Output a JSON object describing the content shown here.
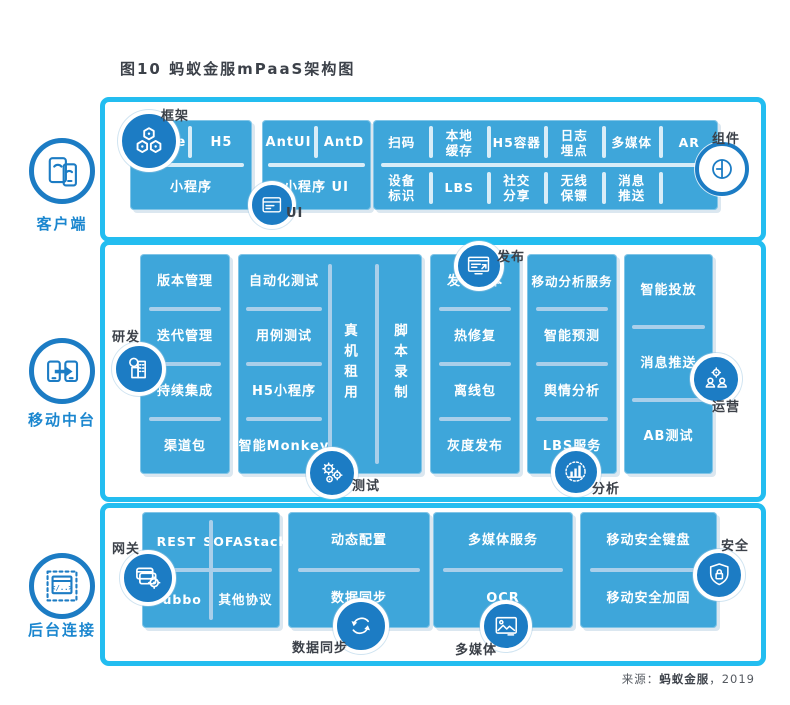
{
  "title": "图10 蚂蚁金服mPaaS架构图",
  "source": {
    "prefix": "来源：",
    "name": "蚂蚁金服",
    "suffix": "，2019"
  },
  "colors": {
    "cyan_border": "#23bdf0",
    "block_blue": "#3ea6da",
    "icon_circle_blue": "#1c7cc4",
    "divider_blue": "#a9cfea",
    "label_dark": "#3c4149",
    "rail_label_blue": "#1a86cf"
  },
  "icons": {
    "client_rail": "mobile-devices",
    "middle_rail": "phone-transfer",
    "backend_rail": "backend-window",
    "frame": "hexagons",
    "ui": "ui-window",
    "component": "split-circle",
    "dev": "magnifier-building",
    "test": "gears",
    "release": "monitor",
    "analysis": "bar-chart",
    "operation": "gear-people",
    "gateway": "cards-gear",
    "sync": "sync-arrows",
    "media": "image",
    "security": "shield-lock"
  },
  "client": {
    "label": "客户端",
    "corner": {
      "frame": "框架",
      "ui": "UI",
      "component": "组件"
    },
    "frame_block": {
      "cells": [
        "Native",
        "H5",
        "小程序"
      ]
    },
    "ui_block": {
      "cells": [
        "AntUI",
        "AntD",
        "小程序 UI"
      ]
    },
    "component_block": {
      "row1": [
        "扫码",
        "本地\n缓存",
        "H5容器",
        "日志\n埋点",
        "多媒体",
        "AR"
      ],
      "row2": [
        "设备\n标识",
        "LBS",
        "社交\n分享",
        "无线\n保镖",
        "消息\n推送",
        ""
      ]
    }
  },
  "middle": {
    "label": "移动中台",
    "corner": {
      "dev": "研发",
      "test": "测试",
      "release": "发布",
      "analysis": "分析",
      "operation": "运营"
    },
    "dev_block": [
      "版本管理",
      "迭代管理",
      "持续集成",
      "渠道包"
    ],
    "test_block": [
      "自动化测试",
      "用例测试",
      "H5小程序",
      "智能Monkey"
    ],
    "test_vertical": [
      "真机租用",
      "脚本录制"
    ],
    "release_block": [
      "发布版本",
      "热修复",
      "离线包",
      "灰度发布"
    ],
    "analysis_block": [
      "移动分析服务",
      "智能预测",
      "舆情分析",
      "LBS服务"
    ],
    "operation_block": [
      "智能投放",
      "消息推送",
      "AB测试"
    ]
  },
  "backend": {
    "label": "后台连接",
    "corner": {
      "gateway": "网关",
      "sync": "数据同步",
      "media": "多媒体",
      "security": "安全"
    },
    "gateway_block": [
      "REST",
      "SOFAStack",
      "Dubbo",
      "其他协议"
    ],
    "sync_block": [
      "动态配置",
      "数据同步"
    ],
    "media_block": [
      "多媒体服务",
      "OCR"
    ],
    "security_block": [
      "移动安全服务",
      "移动安全加固"
    ],
    "security_items": [
      "移动安全键盘",
      "移动安全加固"
    ]
  }
}
